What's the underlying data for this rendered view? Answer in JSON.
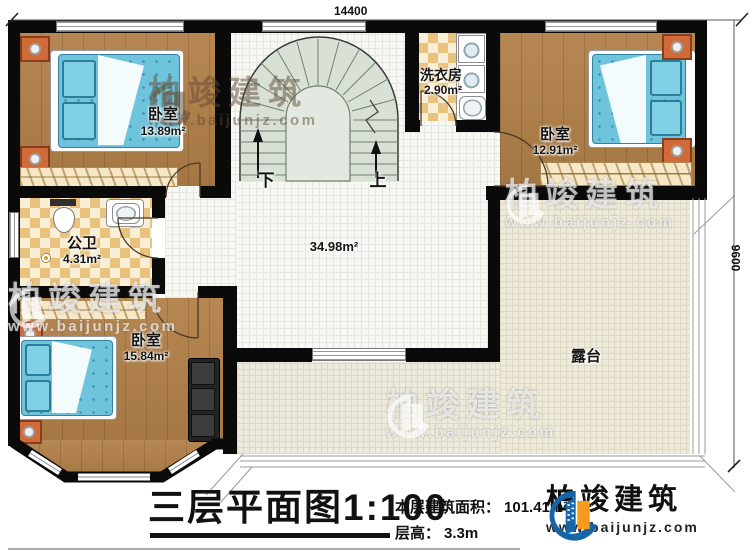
{
  "dimensions": {
    "top": "14400",
    "right": "9600"
  },
  "rooms": {
    "bedroom1": {
      "name": "卧室",
      "area": "13.89m²"
    },
    "bathroom": {
      "name": "公卫",
      "area": "4.31m²"
    },
    "bedroom3": {
      "name": "卧室",
      "area": "15.84m²"
    },
    "laundry": {
      "name": "洗衣房",
      "area": "2.90m²"
    },
    "bedroom2": {
      "name": "卧室",
      "area": "12.91m²"
    },
    "hall": {
      "area": "34.98m²"
    },
    "terrace": {
      "name": "露台"
    }
  },
  "stairs": {
    "down": "下",
    "up": "上"
  },
  "footer": {
    "title": "三层平面图",
    "scale": "1:100",
    "area_label": "本层建筑面积：",
    "area_value": "101.41m²",
    "floor_height_label": "层高：",
    "floor_height_value": "3.3m"
  },
  "brand": {
    "name": "柏竣建筑",
    "url": "www.baijunjz.com"
  },
  "colors": {
    "wall": "#0a0a0a",
    "wood": "#b28048",
    "checker": "#e9c37e",
    "tile": "#f7f7f4",
    "terrace": "#eeeadb",
    "stair": "#d9e1d6",
    "bed": "#6ec4dd",
    "logo_blue": "#1565a8",
    "logo_orange": "#f59a1d"
  }
}
